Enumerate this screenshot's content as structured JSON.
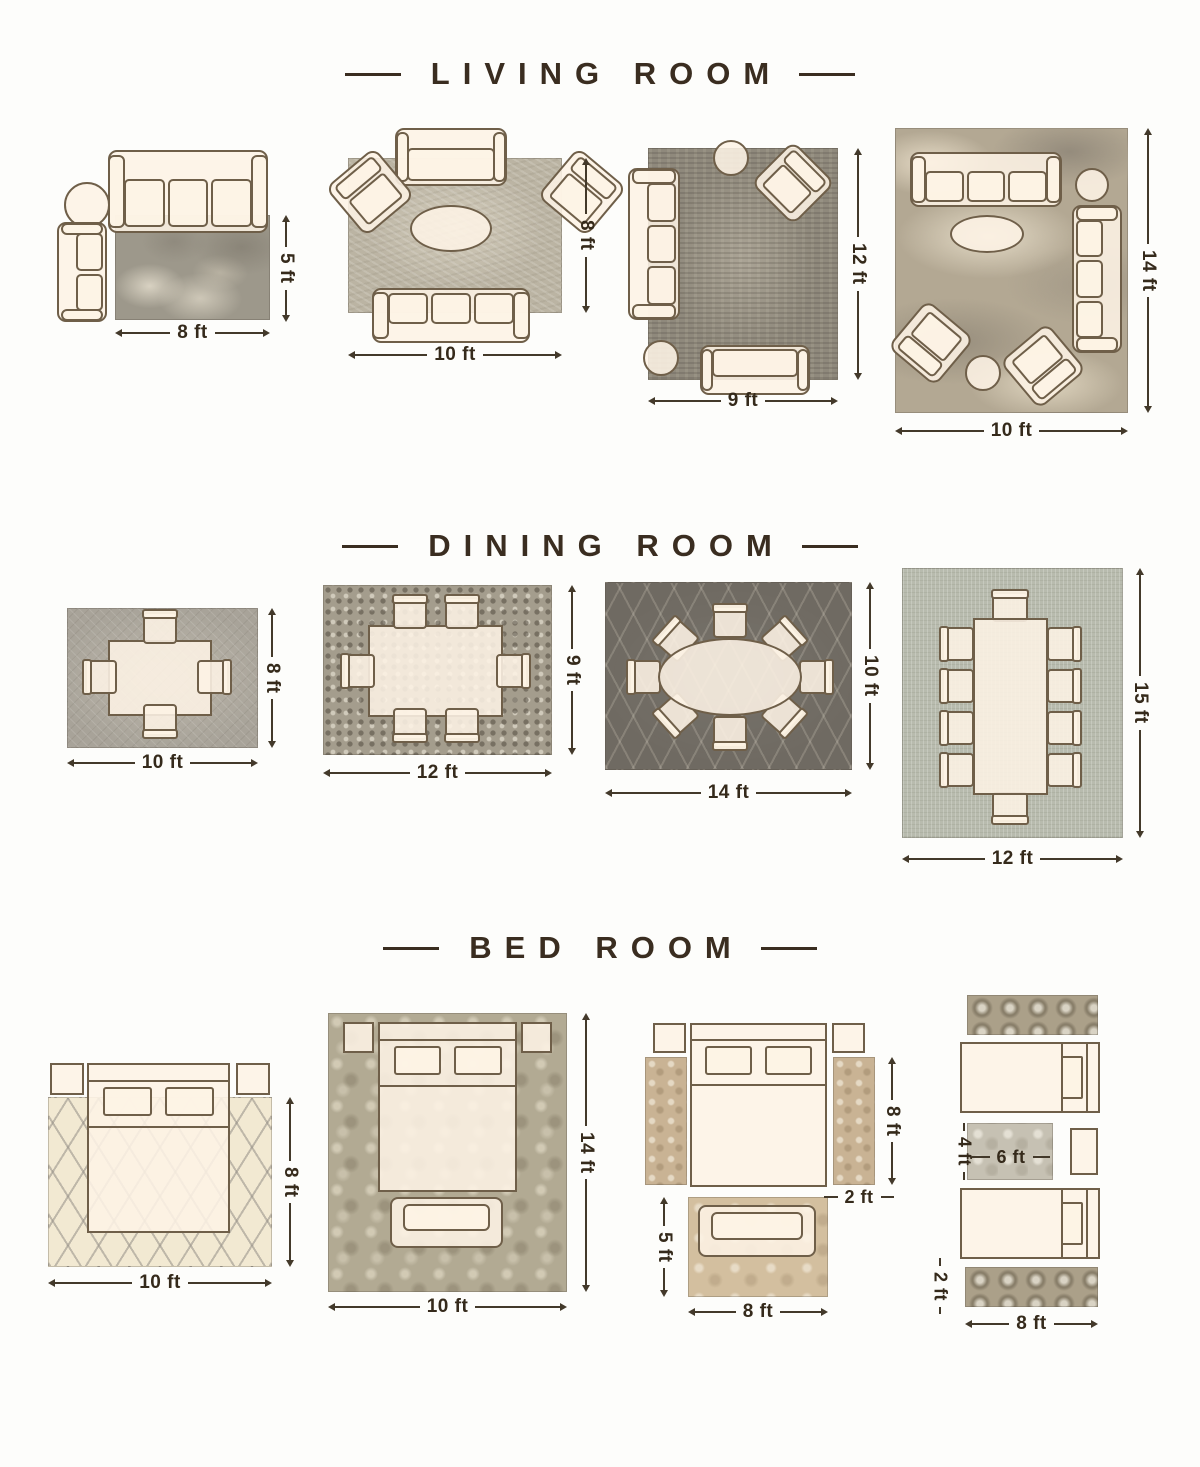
{
  "colors": {
    "title_text": "#3a2d20",
    "dimension_text": "#352a1b",
    "furniture_fill": "#fdf3e5",
    "furniture_outline": "#6f5f49"
  },
  "sections": {
    "living": {
      "title": "LIVING ROOM",
      "layouts": {
        "l1": {
          "width": "8 ft",
          "height": "5 ft"
        },
        "l2": {
          "width": "10 ft",
          "height": "8 ft"
        },
        "l3": {
          "width": "9 ft",
          "height": "12 ft"
        },
        "l4": {
          "width": "10 ft",
          "height": "14 ft"
        }
      }
    },
    "dining": {
      "title": "DINING ROOM",
      "layouts": {
        "d1": {
          "width": "10 ft",
          "height": "8 ft"
        },
        "d2": {
          "width": "12 ft",
          "height": "9 ft"
        },
        "d3": {
          "width": "14 ft",
          "height": "10 ft"
        },
        "d4": {
          "width": "12 ft",
          "height": "15 ft"
        }
      }
    },
    "bedroom": {
      "title": "BED ROOM",
      "layouts": {
        "b1": {
          "width": "10 ft",
          "height": "8 ft"
        },
        "b2": {
          "width": "10 ft",
          "height": "14 ft"
        },
        "b3": {
          "side_runner_length": "8 ft",
          "side_runner_width": "2 ft",
          "foot_rug_height": "5 ft",
          "foot_rug_width": "8 ft"
        },
        "b4": {
          "accent_rug_height": "4 ft",
          "accent_rug_width": "6 ft",
          "runner_height": "2 ft",
          "runner_width": "8 ft"
        }
      }
    }
  }
}
